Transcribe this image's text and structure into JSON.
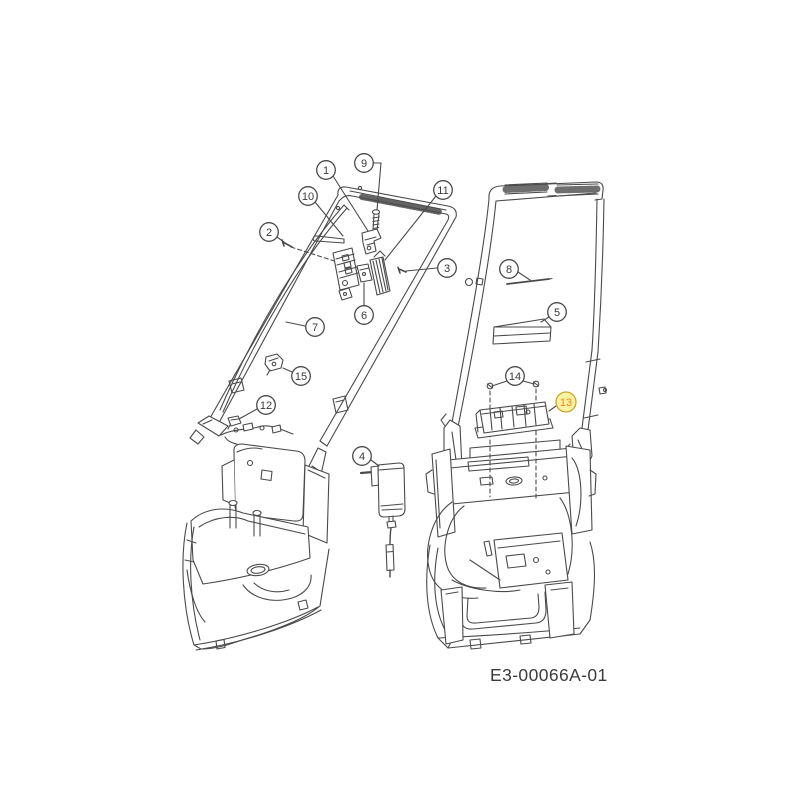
{
  "drawing": {
    "code": "E3-00066A-01",
    "background_color": "#ffffff",
    "line_color": "#4a4a4a",
    "callout_style": {
      "fill": "#ffffff",
      "stroke": "#4a4a4a",
      "text_color": "#3a3a3a",
      "highlight_fill": "#f8f2a2",
      "highlight_stroke": "#c9a62b",
      "highlight_text_color": "#ee8a1f"
    },
    "callouts": [
      {
        "label": "1",
        "x": 326,
        "y": 170,
        "highlighted": false,
        "leaders": [
          [
            333,
            176,
            368,
            231
          ]
        ]
      },
      {
        "label": "2",
        "x": 269,
        "y": 232,
        "highlighted": false,
        "leaders": [
          [
            277,
            237,
            284,
            242
          ]
        ]
      },
      {
        "label": "3",
        "x": 447,
        "y": 268,
        "highlighted": false,
        "leaders": [
          [
            437,
            268,
            406,
            271
          ]
        ]
      },
      {
        "label": "4",
        "x": 362,
        "y": 456,
        "highlighted": false,
        "leaders": [
          [
            371,
            460,
            379,
            466
          ]
        ]
      },
      {
        "label": "5",
        "x": 557,
        "y": 312,
        "highlighted": false,
        "leaders": [
          [
            549,
            317,
            541,
            322
          ]
        ]
      },
      {
        "label": "6",
        "x": 364,
        "y": 315,
        "highlighted": false,
        "leaders": [
          [
            364,
            305,
            364,
            283
          ]
        ]
      },
      {
        "label": "7",
        "x": 315,
        "y": 327,
        "highlighted": false,
        "leaders": [
          [
            305,
            326,
            286,
            322
          ]
        ]
      },
      {
        "label": "8",
        "x": 509,
        "y": 269,
        "highlighted": false,
        "leaders": [
          [
            518,
            272,
            530,
            280
          ]
        ]
      },
      {
        "label": "9",
        "x": 364,
        "y": 163,
        "highlighted": false,
        "leaders": [
          [
            373,
            163,
            381,
            163
          ],
          [
            381,
            163,
            377,
            210
          ]
        ]
      },
      {
        "label": "10",
        "x": 308,
        "y": 196,
        "highlighted": false,
        "leaders": [
          [
            315,
            202,
            343,
            236
          ]
        ]
      },
      {
        "label": "11",
        "x": 443,
        "y": 190,
        "highlighted": false,
        "leaders": [
          [
            436,
            196,
            385,
            260
          ]
        ]
      },
      {
        "label": "12",
        "x": 266,
        "y": 405,
        "highlighted": false,
        "leaders": [
          [
            257,
            409,
            239,
            419
          ]
        ]
      },
      {
        "label": "13",
        "x": 566,
        "y": 402,
        "highlighted": true,
        "leaders": [
          [
            556,
            406,
            549,
            411
          ]
        ]
      },
      {
        "label": "14",
        "x": 515,
        "y": 376,
        "highlighted": false,
        "leaders": [
          [
            507,
            381,
            492,
            386
          ],
          [
            523,
            381,
            534,
            384
          ]
        ]
      },
      {
        "label": "15",
        "x": 301,
        "y": 376,
        "highlighted": false,
        "leaders": [
          [
            292,
            372,
            283,
            368
          ]
        ]
      }
    ]
  }
}
